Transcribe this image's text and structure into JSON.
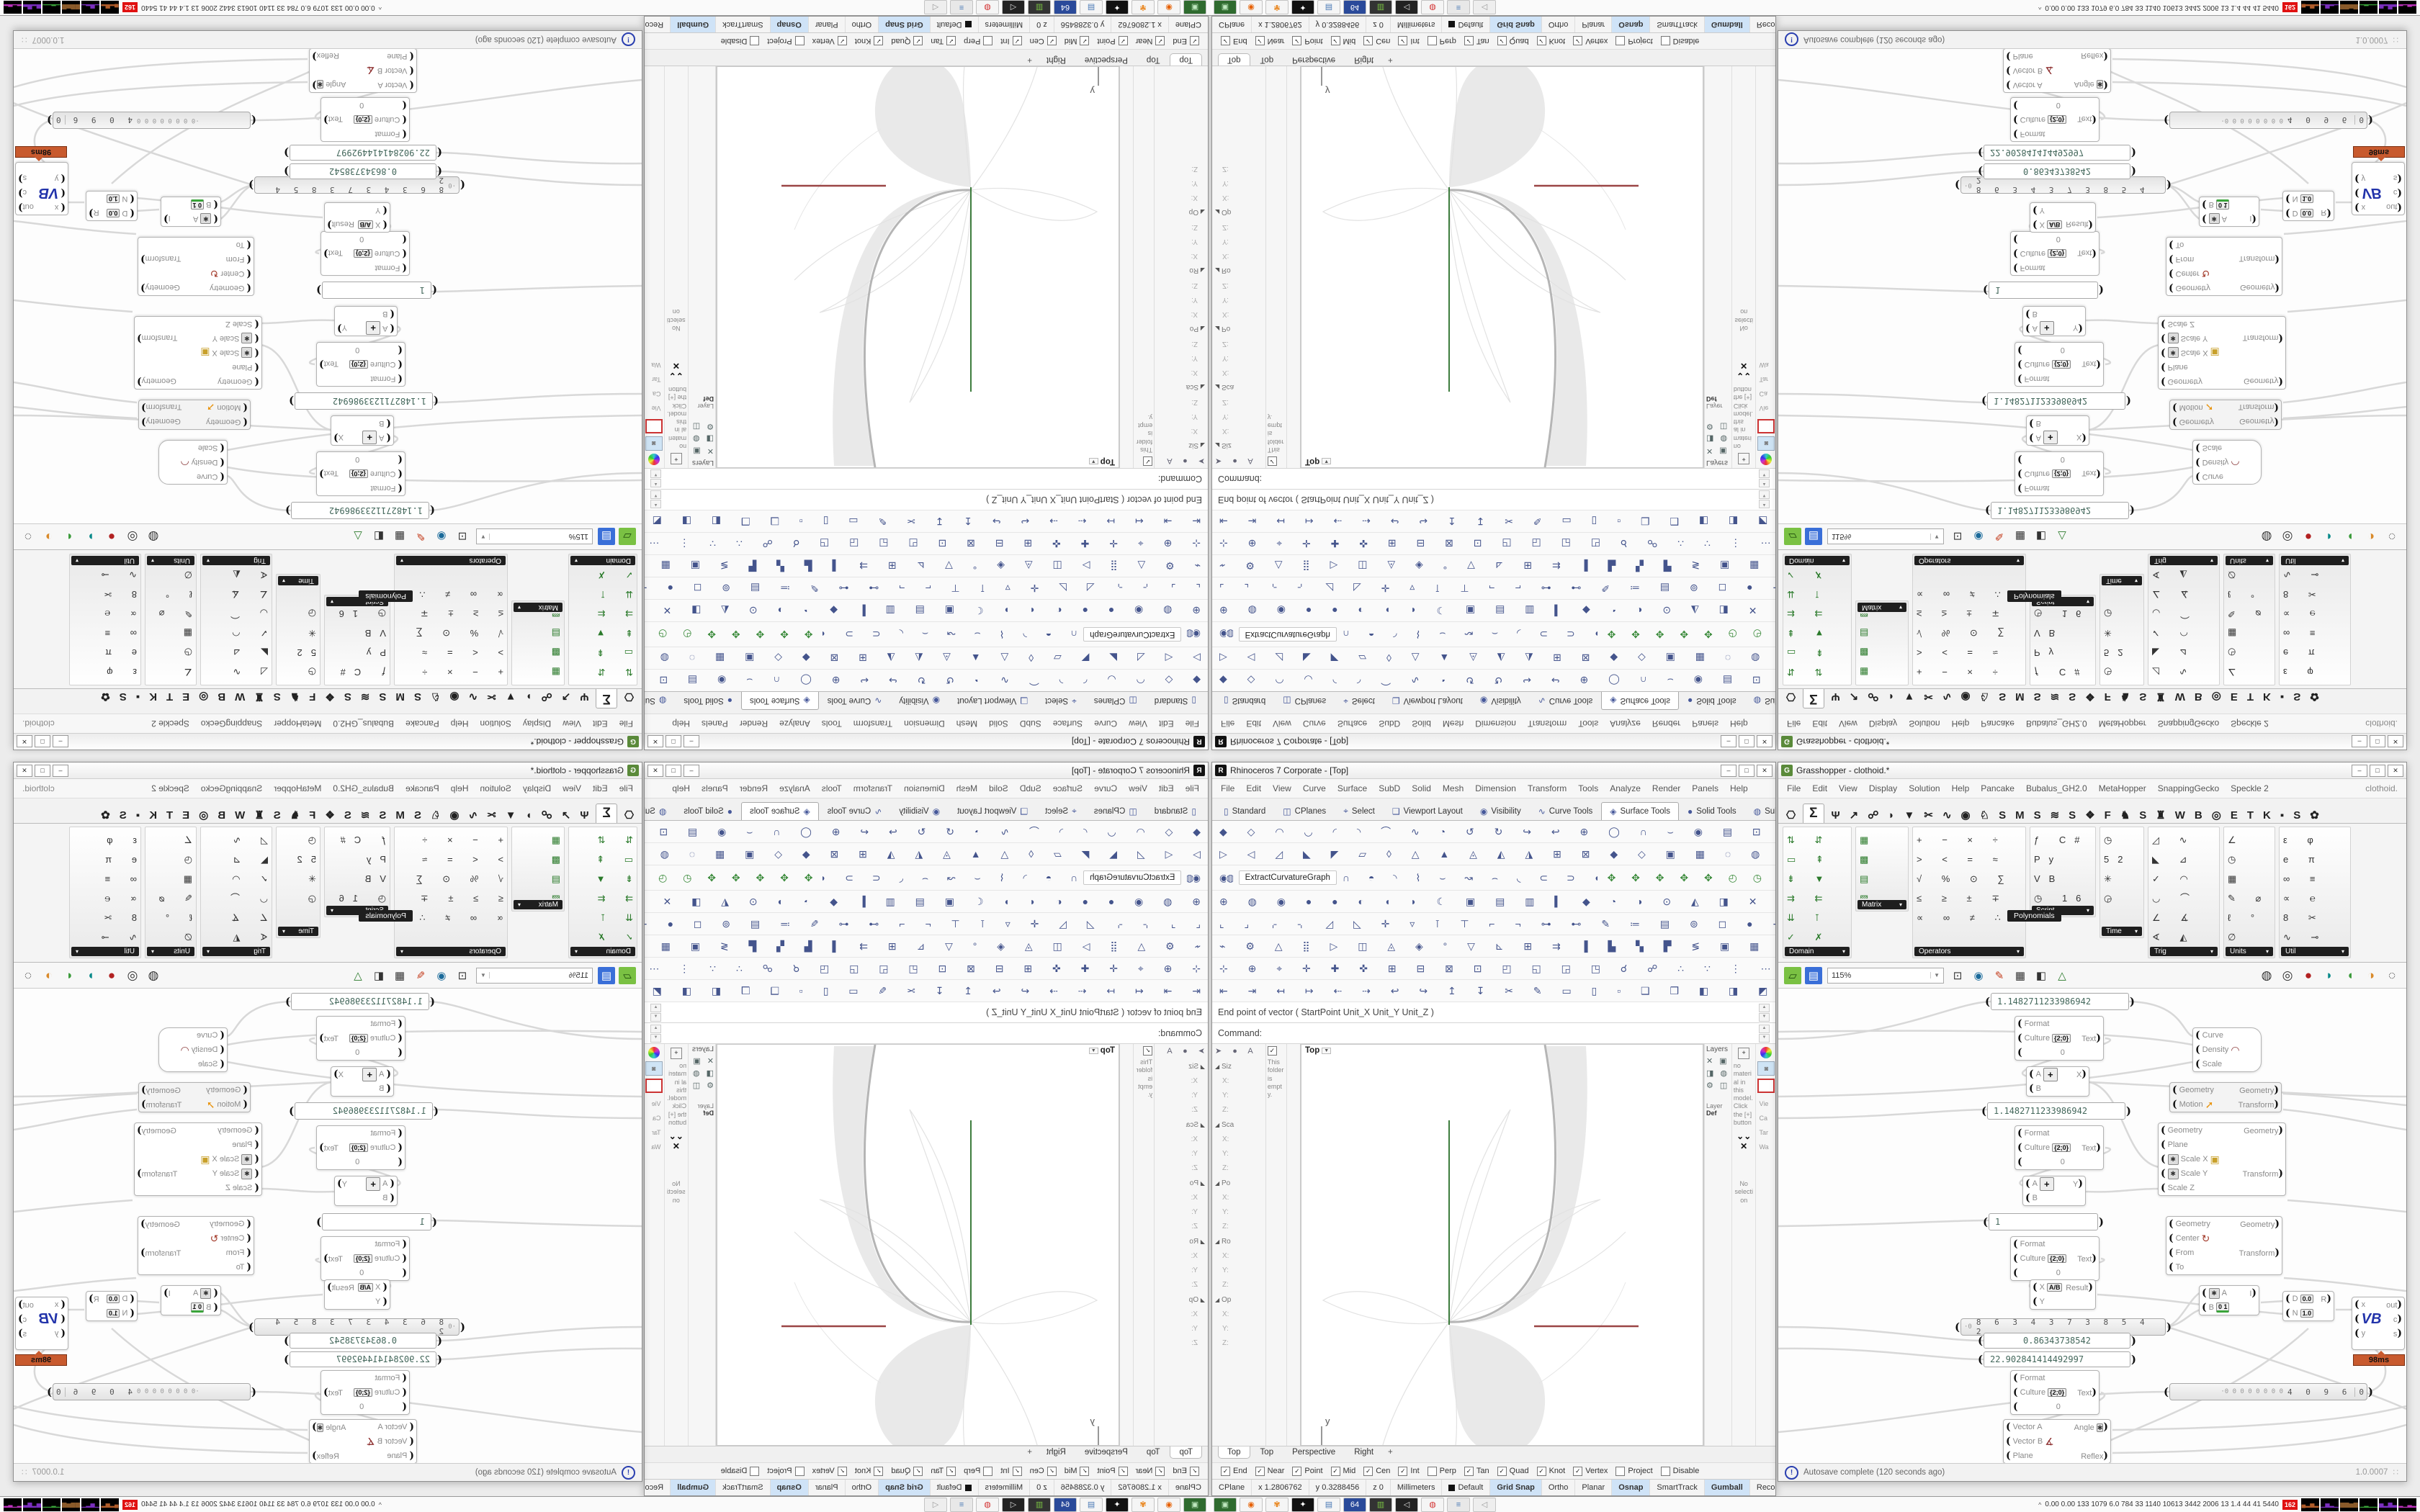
{
  "rhino": {
    "app_icon": "R",
    "title": "Rhinoceros 7 Corporate - [Top]",
    "win_min": "–",
    "win_max": "□",
    "win_close": "✕",
    "menu": [
      "File",
      "Edit",
      "View",
      "Curve",
      "Surface",
      "SubD",
      "Solid",
      "Mesh",
      "Dimension",
      "Transform",
      "Tools",
      "Analyze",
      "Render",
      "Panels",
      "Help"
    ],
    "tabs": [
      {
        "label": "Standard",
        "icon": "▯"
      },
      {
        "label": "CPlanes",
        "icon": "◫"
      },
      {
        "label": "Select",
        "icon": "⌖"
      },
      {
        "label": "Viewport Layout",
        "icon": "❑"
      },
      {
        "label": "Visibility",
        "icon": "◉"
      },
      {
        "label": "Curve Tools",
        "icon": "∿"
      },
      {
        "label": "Surface Tools",
        "icon": "◈",
        "active": true
      },
      {
        "label": "Solid Tools",
        "icon": "●"
      },
      {
        "label": "SubD",
        "icon": "◍"
      }
    ],
    "tabs_overflow": "»",
    "tabs_gear": "⚙",
    "toolbar_rows_top": [
      "◆ ◇ ◠ ◡ ◜ ◝ ⌒ ∿ ◔ ↺ ↻ ↪ ↩ ⊕ ◯ ∩ ⌣ ◉ ▤ ⊡ ◈ ◊ ⊙ ✦ ➤ ≈ ⌖ ✚",
      "▷ ◁ ◿ ◣ ◤ ▱ ◊ △ ▲ ◬ ◭ ◮ ⊞ ⊠ ◆ ◇ ▣ ▦ ◌ ◍ ● ⚑ ≡ ✜ ❖ ▰ ▫ ◧"
    ],
    "row3": {
      "globe": "◉",
      "jar": "◍",
      "button": "ExtractCurvatureGraph",
      "icons": "∩ ◓ ◝ ⌇ ⌣ ↝ ⌢ ◟ ⊂ ⊃ ◖ ◗ ⊛ ◎ ⊜ ○ ● ◦ ◠ ◡",
      "colored": "✥ ✥ ✥ ✥ ✥ ◴ ◷"
    },
    "toolbar_rows_bottom": [
      "⊕ ◍ ◉ ● ● ◐ ◖ ◗ ☾ ▣ ▤ ▥ ▍ ◆ ◔ ◑ ⊙ ◭ ◨ ✕ ▢ ◳ ◰ ◩",
      "⌞ ⌟ ⌌ ⌍ ◿ ◺ ✛ ▿ ⊺ ⊤ ⌐ ¬ ⊶ ⊷ ✎ ≔ ▤ ⊚ ◻ ● ⊹ ▪ ▫ ◘",
      "⌁ ⚙ △ ⣿ ▷ ◫ ◬ ◈ ° ▽ ⊾ ⊞ ⇉ ▐ ▙ ▚ ▛ ≶ ▣ ▦ ➡ ▎ ◪ ▞",
      "⊹ ⊕ ⌖ ✛ ✚ ✜ ⊞ ⊟ ⊠ ⊡ ◰ ◱ ◲ ◳ ☌ ☍ ∴ ∵ ⋮ ⋯ ▒ ░ ▓ ※",
      "⇤ ⇥ ↤ ↦ ⇠ ⇢ ↩ ↪ ↥ ↧ ✂ ✎ ▭ ▯ ▫ ❑ ❒ ◧ ◨ ◩ ◪ ▨ ▧ ▩"
    ],
    "command_history": "End point of vector ( StartPoint  Unit_X  Unit_Y  Unit_Z )",
    "command_prompt": "Command:",
    "left_panel": {
      "icons": "➤ ● A",
      "empty_note": "This folder is empty.",
      "sections": [
        "Siz",
        "Sca",
        "Po",
        "Ro",
        "Op"
      ],
      "f1": "X:",
      "f2": "Y:",
      "f3": "Z:"
    },
    "viewport": {
      "label": "Top",
      "axis_x": "x",
      "axis_y": "y"
    },
    "right_panels": {
      "layers_title": "Layers",
      "layers_icons": "✕ ▣ ◨ ◍ ⚙ ◫",
      "layer_label": "Layer",
      "def_label": "Def",
      "materials_note": "no material in this model. Click the [+] button",
      "chevrons": "⌄⌄",
      "no_selection": "No selection",
      "view_labels": [
        "Vie",
        "Ca",
        "Tar",
        "Wa"
      ]
    },
    "viewport_tabs": [
      {
        "label": "Top",
        "active": true
      },
      {
        "label": "Top"
      },
      {
        "label": "Perspective"
      },
      {
        "label": "Right"
      }
    ],
    "add_tab": "+",
    "osnap": [
      {
        "label": "End",
        "checked": true
      },
      {
        "label": "Near",
        "checked": true
      },
      {
        "label": "Point",
        "checked": true
      },
      {
        "label": "Mid",
        "checked": true
      },
      {
        "label": "Cen",
        "checked": true
      },
      {
        "label": "Int",
        "checked": true
      },
      {
        "label": "Perp"
      },
      {
        "label": "Tan",
        "checked": true
      },
      {
        "label": "Quad",
        "checked": true
      },
      {
        "label": "Knot",
        "checked": true
      },
      {
        "label": "Vertex",
        "checked": true
      },
      {
        "label": "Project"
      },
      {
        "label": "Disable"
      }
    ],
    "status": {
      "cplane": "CPlane",
      "x": "x 1.2806762",
      "y": "y 0.3288456",
      "z": "z 0",
      "units": "Millimeters",
      "layer": "Default",
      "toggles": [
        {
          "label": "Grid Snap",
          "on": true
        },
        {
          "label": "Ortho"
        },
        {
          "label": "Planar"
        },
        {
          "label": "Osnap",
          "on": true
        },
        {
          "label": "SmartTrack"
        },
        {
          "label": "Gumball",
          "on": true
        },
        {
          "label": "Record History"
        },
        {
          "label": "Filter"
        }
      ]
    }
  },
  "grasshopper": {
    "app_icon": "G",
    "title": "Grasshopper - clothoid.*",
    "win_min": "–",
    "win_max": "□",
    "win_close": "✕",
    "menu": [
      "File",
      "Edit",
      "View",
      "Display",
      "Solution",
      "Help",
      "Pancake",
      "Bubalus_GH2.0",
      "MetaHopper",
      "SnappingGecko",
      "Speckle 2"
    ],
    "menu_right": "clothoid.",
    "tab_icons": [
      {
        "g": "⎔"
      },
      {
        "g": "Σ",
        "active": true
      },
      {
        "g": "Ψ"
      },
      {
        "g": "↗"
      },
      {
        "g": "☍"
      },
      {
        "g": "◗"
      },
      {
        "g": "▼"
      },
      {
        "g": "✂"
      },
      {
        "g": "∿"
      },
      {
        "g": "◉"
      },
      {
        "g": "♘"
      },
      {
        "g": "S"
      },
      {
        "g": "M"
      },
      {
        "g": "S"
      },
      {
        "g": "≋"
      },
      {
        "g": "S"
      },
      {
        "g": "❖"
      },
      {
        "g": "F"
      },
      {
        "g": "♞"
      },
      {
        "g": "S"
      },
      {
        "g": "♜"
      },
      {
        "g": "W"
      },
      {
        "g": "B"
      },
      {
        "g": "◎"
      },
      {
        "g": "E"
      },
      {
        "g": "T"
      },
      {
        "g": "K"
      },
      {
        "g": "▪"
      },
      {
        "g": "S"
      },
      {
        "g": "✿"
      }
    ],
    "ribbon_groups": [
      {
        "label": "Domain",
        "icons": "⇅ ⇵ ▭ ⇞ ⇟ ▼ ⇉ ⇇ ⇊ ⊺ ✓ ✗ ↕ ↔ ▤",
        "w": 96,
        "h": 183,
        "color": "#2a7a2a"
      },
      {
        "label": "Matrix",
        "icons": "▦ ▩ ▤ ▧ ▨ ⊞",
        "w": 74,
        "h": 118,
        "color": "#2a7a2a"
      },
      {
        "label": "Operators",
        "icons": "+ − × ÷ > < = ≈ √ % ⊙ ∑ ≤ ≥ ± ∓ ∝ ∞ ≠ ∴",
        "w": 158,
        "h": 183,
        "color": "#333333"
      },
      {
        "label": "Script",
        "icons": "ƒ C# Py VB ◷ 16",
        "w": 92,
        "h": 126,
        "color": "#333333"
      },
      {
        "label": "Time",
        "icons": "◷ 52 ✳ ◶",
        "w": 62,
        "h": 155,
        "color": "#333333"
      },
      {
        "label": "Trig",
        "icons": "◿ ∿ ◣ ⊿ ✓ ◠ ◡ ⌒ ∠ ∡ ∢ ◭",
        "w": 100,
        "h": 183,
        "color": "#333333"
      },
      {
        "label": "Units",
        "icons": "∠ ◷ ▦ ✎ ⌀ ℓ ° ∅",
        "w": 72,
        "h": 183,
        "color": "#333333"
      },
      {
        "label": "Util",
        "icons": "ε φ e π ∞ ≡ ∝ ℮ 8 ✂ ∿ ⊸",
        "w": 100,
        "h": 183,
        "color": "#333333"
      }
    ],
    "ribbon_tooltip": "Polynomials",
    "canvas_tools_left": [
      {
        "g": "▱",
        "bg": "#7ac143",
        "fg": "#1c4a0c"
      },
      {
        "g": "▤",
        "bg": "#3a6fd8",
        "fg": "#ffffff"
      }
    ],
    "zoom": "115%",
    "canvas_tools_mid": [
      {
        "g": "⊡"
      },
      {
        "g": "◉",
        "fg": "#1a6a9a"
      },
      {
        "g": "✎",
        "fg": "#c33a1a"
      },
      {
        "g": "▦"
      },
      {
        "g": "◧"
      },
      {
        "g": "△",
        "fg": "#2a7a2a"
      }
    ],
    "canvas_tools_right": [
      {
        "g": "◍"
      },
      {
        "g": "◎"
      },
      {
        "g": "●",
        "fg": "#b22222"
      },
      {
        "g": "◗",
        "fg": "#0a8a8a"
      },
      {
        "g": "◖",
        "fg": "#3a9a3a"
      },
      {
        "g": "◑",
        "fg": "#d98a2a"
      },
      {
        "g": "◌"
      }
    ],
    "status_left": "Autosave complete (120 seconds ago)",
    "status_icon": "!",
    "status_right": "1.0.0007",
    "nodes": {
      "panel1": "1.1482711233986942",
      "panel2": "1.1482711233986942",
      "panel3": "1",
      "panel4": "0.86343738542",
      "panel5": "22.902841414492997",
      "format": {
        "in1": "Format",
        "in2": "Culture",
        "in3": "0",
        "out": "Text",
        "badge": "{2;0}"
      },
      "addx": {
        "a": "A",
        "b": "B",
        "out": "X",
        "plus": "+"
      },
      "addy": {
        "a": "A",
        "b": "B",
        "out": "Y",
        "plus": "+"
      },
      "cgraph": {
        "in1": "Curve",
        "in2": "Density",
        "in3": "Scale",
        "icon": "◠"
      },
      "move": {
        "in1": "Geometry",
        "in2": "Motion",
        "out1": "Geometry",
        "out2": "Transform",
        "icon": "➚"
      },
      "scale": {
        "in1": "Geometry",
        "in2": "Plane",
        "in3": "Scale X",
        "in4": "Scale Y",
        "in5": "Scale Z",
        "out1": "Geometry",
        "out2": "Transform",
        "icon": "▣"
      },
      "rotate": {
        "in1": "Geometry",
        "in2": "Center",
        "in3": "From",
        "in4": "To",
        "out1": "Geometry",
        "out2": "Transform",
        "icon": "↻"
      },
      "division": {
        "in1": "X",
        "in2": "Y",
        "out": "Result",
        "badge": "A/B"
      },
      "slider1": {
        "prefix": "·0",
        "digits": "8 6 3 4 3 7 3 8 5 4 2"
      },
      "slider2": {
        "prefix": "·0 0 0 0 0 0 0 0",
        "digits": "4 0 9 6",
        "end": "0"
      },
      "cdomain": {
        "a": "A",
        "b": "B",
        "out": "I",
        "badge": "0 1"
      },
      "ddomain": {
        "d": "D",
        "n": "N",
        "out": "R",
        "badge1": "0.0",
        "badge2": "1.0"
      },
      "vb": {
        "x": "x",
        "y": "y",
        "out1": "out",
        "out2": "c",
        "out3": "s",
        "logo": "VB",
        "tooltip": "98ms"
      },
      "angle": {
        "in1": "Vector A",
        "in2": "Vector B",
        "in3": "Plane",
        "out1": "Angle",
        "out2": "Reflex",
        "icon": "∡"
      }
    }
  },
  "taskbar": {
    "apps": [
      {
        "g": "▣",
        "bg": "#2f6b2f",
        "fg": "#bfe8bf"
      },
      {
        "g": "◉",
        "bg": "#f5f5f5",
        "fg": "#e66000"
      },
      {
        "g": "✾",
        "bg": "#f5f5f5",
        "fg": "#e87d0d"
      },
      {
        "g": "✦",
        "bg": "#111111",
        "fg": "#ffffff"
      },
      {
        "g": "▤",
        "bg": "#f5f5f5",
        "fg": "#4a7ab5"
      },
      {
        "g": "64",
        "bg": "#2a4a9a",
        "fg": "#ffffff"
      },
      {
        "g": "▥",
        "bg": "#333333",
        "fg": "#7ac143"
      },
      {
        "g": "◁",
        "bg": "#222222",
        "fg": "#dddddd"
      },
      {
        "g": "◍",
        "bg": "#f5f5f5",
        "fg": "#d33333"
      },
      {
        "g": "≡",
        "bg": "#e8e8e8",
        "fg": "#4a7ab5"
      },
      {
        "g": "◁",
        "bg": "#eeeeee",
        "fg": "#999999"
      }
    ],
    "tray": {
      "chevron": "^",
      "stats": "0.00 0.00  133  1079  6.0  784  33  1140 10613 3442 2006  13  1.4  44  41  5440",
      "alert": "162",
      "graphs": [
        {
          "bars": "▄▂▅▂",
          "fg": "#b05c2a"
        },
        {
          "bars": "▁▅▂▁",
          "fg": "#7b2fbe"
        },
        {
          "bars": "▆▆▅▆",
          "fg": "#8a5a2a"
        },
        {
          "bars": "▁▂▁▁",
          "fg": "#3aa43a"
        },
        {
          "bars": "▅▂▆▃",
          "fg": "#7b2fbe"
        },
        {
          "bars": "▂▁▃▂",
          "fg": "#bb33bb"
        }
      ]
    }
  }
}
